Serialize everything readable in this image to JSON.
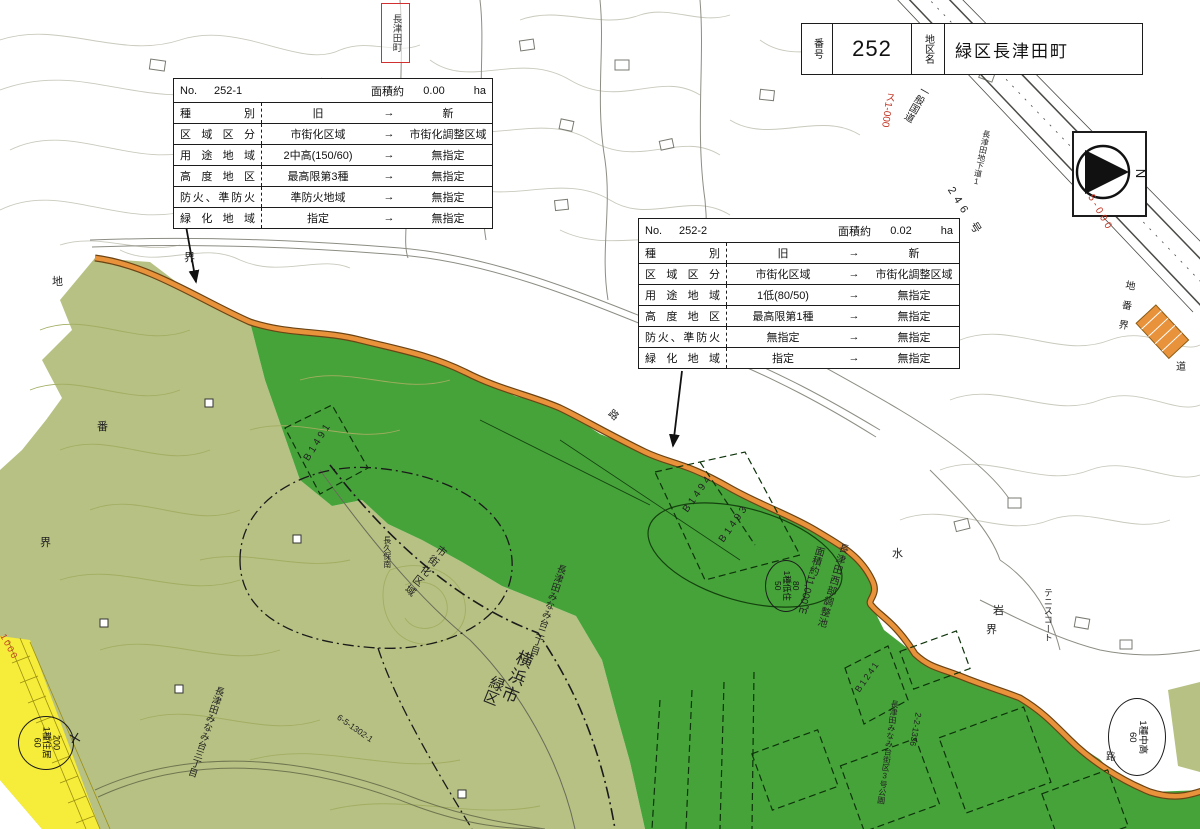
{
  "district_header": {
    "no_label": "番号",
    "no_value": "252",
    "name_label": "地区名",
    "name_value": "緑区長津田町"
  },
  "compass": {
    "north_label": "N"
  },
  "colors": {
    "dark_green": "#46a33a",
    "olive_green": "#b7c183",
    "yellow_zone": "#f6ec3a",
    "orange_boundary": "#e8923c",
    "red_annotation": "#c23322"
  },
  "tables": [
    {
      "no_label": "No.",
      "no_value": "252-1",
      "area_label": "面積約",
      "area_value": "0.00",
      "area_unit": "ha",
      "rows": [
        {
          "label": "種別",
          "old": "旧",
          "arrow": "→",
          "new": "新"
        },
        {
          "label": "区域区分",
          "old": "市街化区域",
          "arrow": "→",
          "new": "市街化調整区域"
        },
        {
          "label": "用途地域",
          "old": "2中高(150/60)",
          "arrow": "→",
          "new": "無指定"
        },
        {
          "label": "高度地区",
          "old": "最高限第3種",
          "arrow": "→",
          "new": "無指定"
        },
        {
          "label": "防火、準防火",
          "old": "準防火地域",
          "arrow": "→",
          "new": "無指定"
        },
        {
          "label": "緑化地域",
          "old": "指定",
          "arrow": "→",
          "new": "無指定"
        }
      ]
    },
    {
      "no_label": "No.",
      "no_value": "252-2",
      "area_label": "面積約",
      "area_value": "0.02",
      "area_unit": "ha",
      "rows": [
        {
          "label": "種別",
          "old": "旧",
          "arrow": "→",
          "new": "新"
        },
        {
          "label": "区域区分",
          "old": "市街化区域",
          "arrow": "→",
          "new": "市街化調整区域"
        },
        {
          "label": "用途地域",
          "old": "1低(80/50)",
          "arrow": "→",
          "new": "無指定"
        },
        {
          "label": "高度地区",
          "old": "最高限第1種",
          "arrow": "→",
          "new": "無指定"
        },
        {
          "label": "防火、準防火",
          "old": "無指定",
          "arrow": "→",
          "new": "無指定"
        },
        {
          "label": "緑化地域",
          "old": "指定",
          "arrow": "→",
          "new": "無指定"
        }
      ]
    }
  ],
  "map_labels": {
    "town_box": "長津田町",
    "parcel_chi": "地",
    "parcel_ban": "番",
    "parcel_kai": "界",
    "kai_top": "界",
    "ro_center": "路",
    "water": "水",
    "iwa": "岩",
    "kai_right": "界",
    "tennis_court": "テニスコート",
    "regulating_pond": "長津田西部調整池",
    "pond_area": "面積約11,000㎡",
    "bubble_pond": {
      "top": "80",
      "mid": "1種低住",
      "bottom": "50"
    },
    "bubble_yellow": {
      "top": "200",
      "mid": "1種住居",
      "bottom": "60"
    },
    "bubble_corner": {
      "mid": "1種中高",
      "bottom": "60"
    },
    "b1491": "B1491",
    "b1494": "B1494",
    "b1493": "B1493",
    "b1241": "B1241",
    "lot_2_2_1336": "2-2-1336",
    "park": "長津田みなみ台街区3号公園",
    "minamidai2": "長津田みなみ台二丁目",
    "minamidai3": "長津田みなみ台三丁目",
    "lot_6_5": "6-5-1302-1",
    "yokohama": "横浜市",
    "midoriku": "緑区",
    "shigaika_kuiki": "市街化区域",
    "nagakubo": "長久保南",
    "kokudo": "一般国道",
    "route246": "246 号",
    "underpass": "長津田地下道1",
    "sheet_su1": "ス1-000",
    "sheet_5000": "5-000",
    "sheet_1000": "1000",
    "chibankai": "地番界",
    "michi": "道",
    "ro_corner": "路"
  }
}
